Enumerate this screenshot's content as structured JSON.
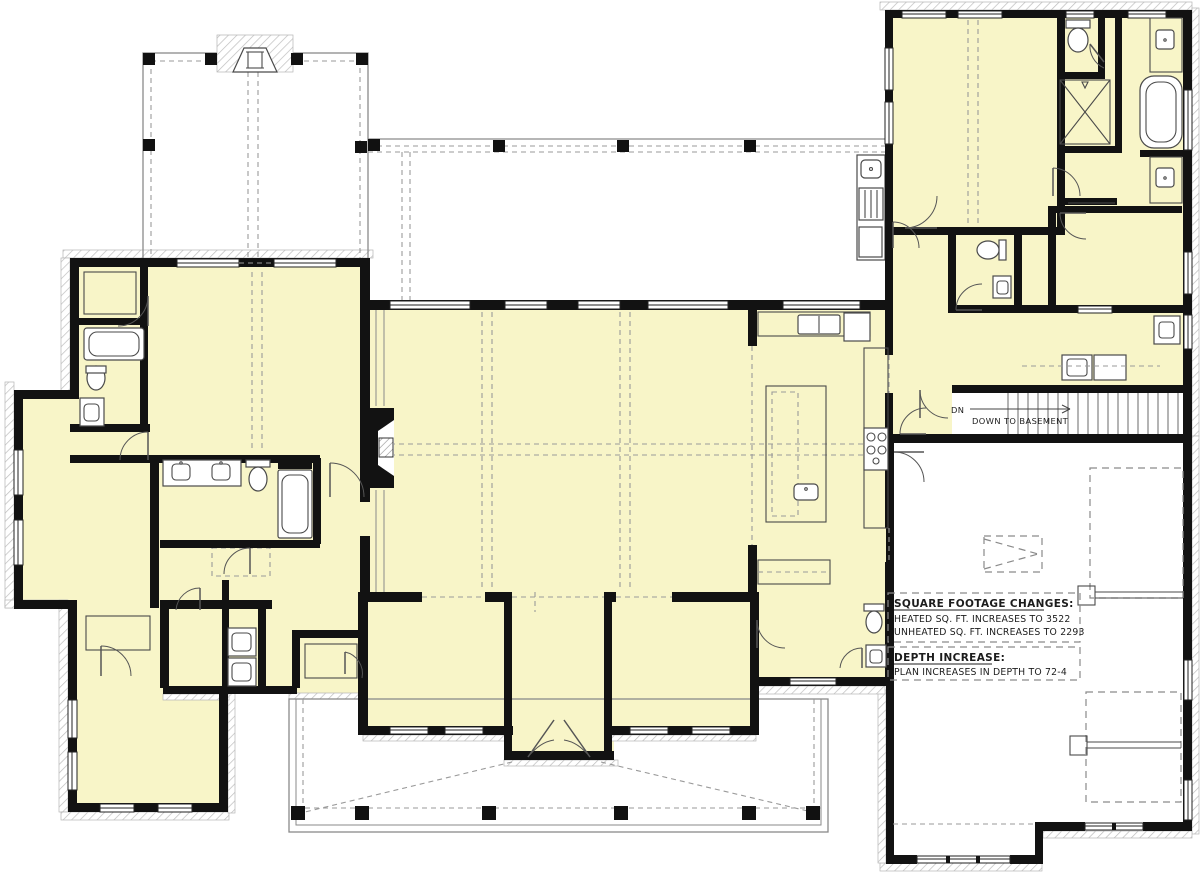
{
  "drawing": {
    "kind": "floor-plan-modification-diagram",
    "colors": {
      "room_fill": "#F8F5C8",
      "wall": "#121212",
      "line_gray": "#8a8a8a",
      "hatch_gray": "#c3c3c3",
      "fixture_gray": "#4a4a4a",
      "text_color": "#1c1c1c"
    },
    "notes": {
      "sqft": {
        "title": "SQUARE FOOTAGE CHANGES:",
        "lines": [
          "HEATED SQ. FT. INCREASES TO 3522",
          "UNHEATED SQ. FT. INCREASES TO 2293"
        ]
      },
      "depth": {
        "title": "DEPTH INCREASE:",
        "lines": [
          "PLAN INCREASES IN DEPTH TO 72-4"
        ]
      }
    },
    "stairs": {
      "dn": "DN",
      "label": "DOWN TO BASEMENT"
    }
  }
}
